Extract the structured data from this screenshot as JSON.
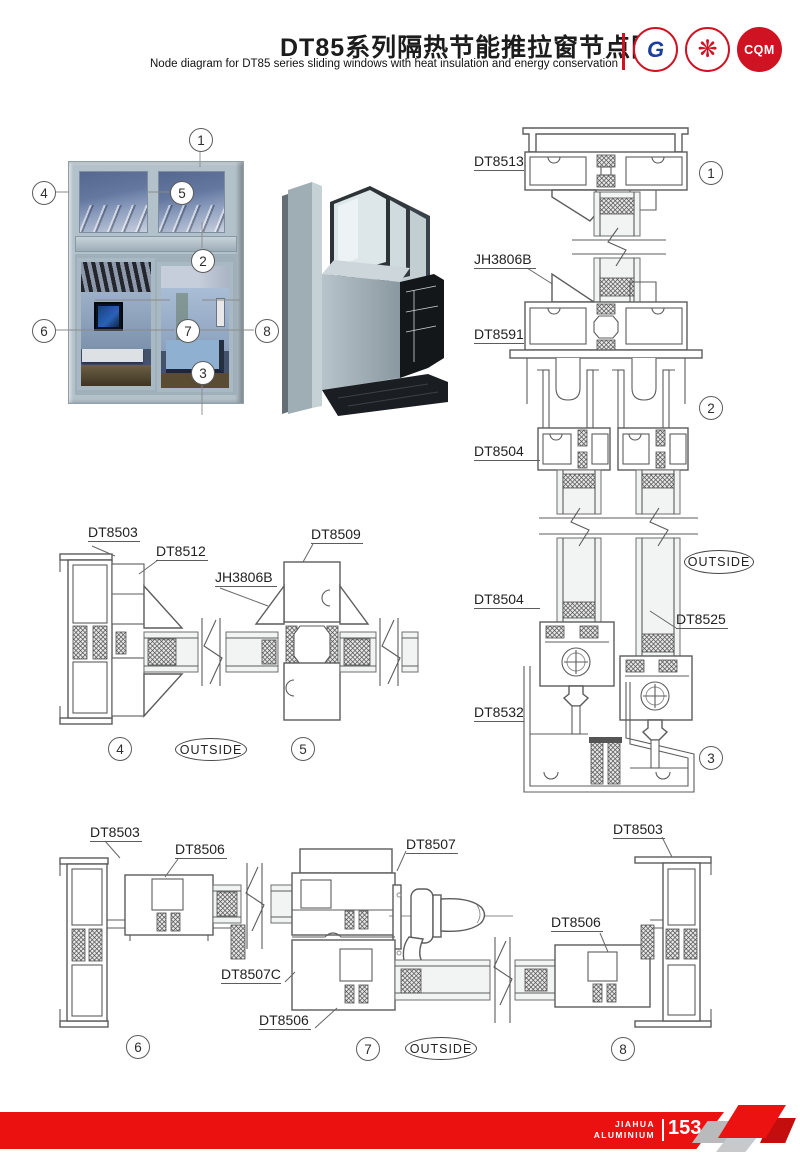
{
  "header": {
    "title_cn": "DT85系列隔热节能推拉窗节点图",
    "title_en": "Node diagram for DT85 series sliding windows with heat insulation and energy conservation",
    "logos": [
      {
        "name": "jiahua-g-logo",
        "text": "G"
      },
      {
        "name": "certification-seal-logo",
        "text": "❋"
      },
      {
        "name": "cqm-logo",
        "text": "CQM"
      }
    ]
  },
  "photo": {
    "callouts": [
      {
        "n": "1"
      },
      {
        "n": "2"
      },
      {
        "n": "3"
      },
      {
        "n": "4"
      },
      {
        "n": "5"
      },
      {
        "n": "6"
      },
      {
        "n": "7"
      },
      {
        "n": "8"
      }
    ]
  },
  "diagrams": {
    "right": {
      "labels": [
        {
          "text": "DT8513"
        },
        {
          "text": "JH3806B"
        },
        {
          "text": "DT8591"
        },
        {
          "text": "DT8504"
        },
        {
          "text": "DT8504"
        },
        {
          "text": "DT8525"
        },
        {
          "text": "DT8532"
        }
      ],
      "callouts": [
        "1",
        "2",
        "3"
      ],
      "outside": "OUTSIDE"
    },
    "middle": {
      "labels": [
        {
          "text": "DT8503"
        },
        {
          "text": "DT8512"
        },
        {
          "text": "JH3806B"
        },
        {
          "text": "DT8509"
        }
      ],
      "callouts": [
        "4",
        "5"
      ],
      "outside": "OUTSIDE"
    },
    "bottom": {
      "labels": [
        {
          "text": "DT8503"
        },
        {
          "text": "DT8506"
        },
        {
          "text": "DT8507"
        },
        {
          "text": "DT8503"
        },
        {
          "text": "DT8506"
        },
        {
          "text": "DT8507C"
        },
        {
          "text": "DT8506"
        }
      ],
      "callouts": [
        "6",
        "7",
        "8"
      ],
      "outside": "OUTSIDE"
    }
  },
  "footer": {
    "brand_top": "JIAHUA",
    "brand_bottom": "ALUMINIUM",
    "page_number": "153"
  },
  "colors": {
    "accent_red": "#ec1111",
    "line_gray": "#5c5c5c"
  }
}
